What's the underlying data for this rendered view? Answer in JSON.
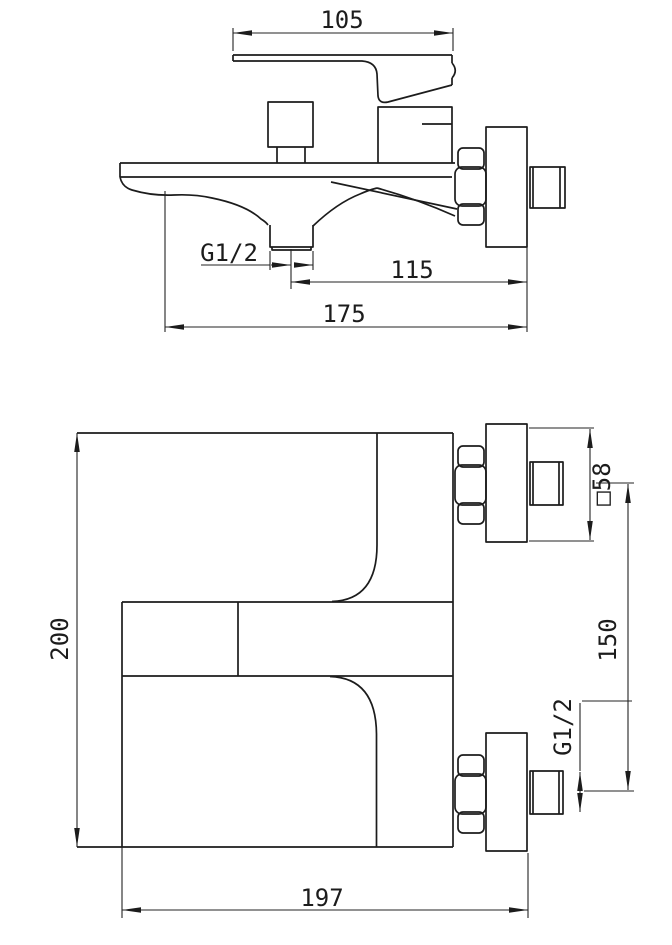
{
  "drawing": {
    "type": "technical-dimension-drawing",
    "subject": "wall-mounted bath mixer faucet, two orthographic views"
  },
  "colors": {
    "background": "#ffffff",
    "line": "#1c1c1c"
  },
  "views": {
    "side": {
      "dims": {
        "handle_length": "105",
        "spout_thread": "G1/2",
        "spout_center_to_wall": "115",
        "overall_depth": "175"
      }
    },
    "front": {
      "dims": {
        "overall_height": "200",
        "flange_square": "□58",
        "inlet_centers": "150",
        "inlet_thread": "G1/2",
        "overall_width": "197"
      }
    }
  }
}
